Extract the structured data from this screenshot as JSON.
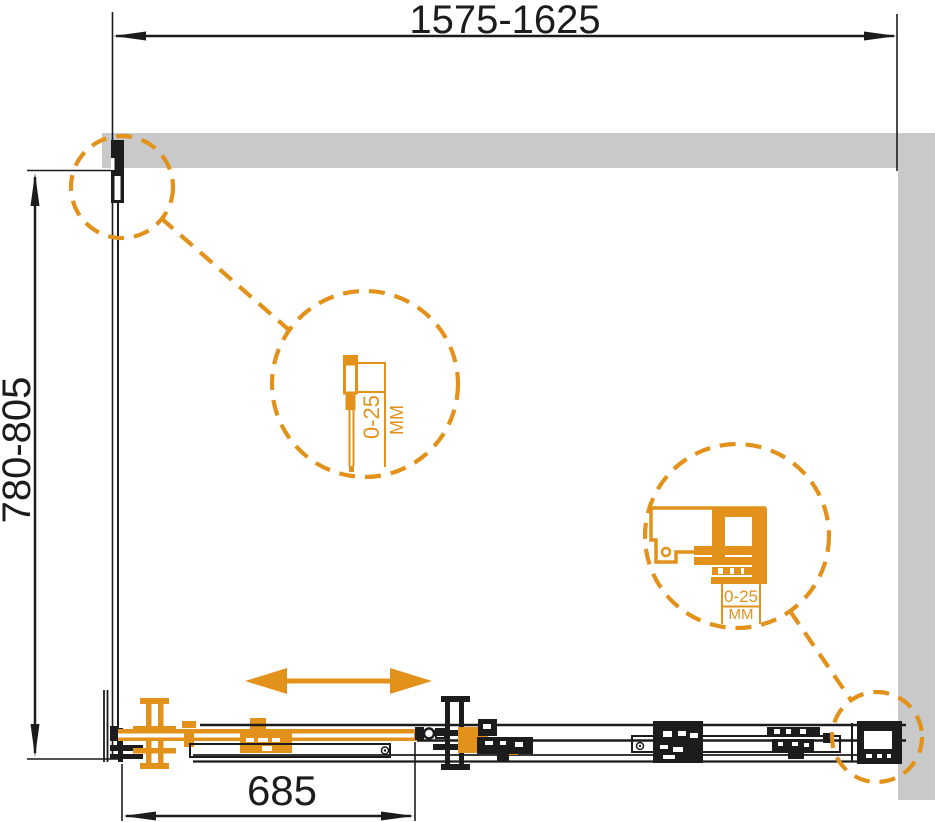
{
  "title": "shower-enclosure-installation-drawing",
  "colors": {
    "accent": "#E2921A",
    "wall": "#C9C9C9",
    "ink": "#1C1C1C"
  },
  "dimensions": {
    "top": "1575-1625",
    "left": "780-805",
    "bottom": "685"
  },
  "details": {
    "wall_profile": {
      "range": "0-25",
      "unit": "MM"
    },
    "roller": {
      "range": "0-25",
      "unit": "MM"
    }
  }
}
